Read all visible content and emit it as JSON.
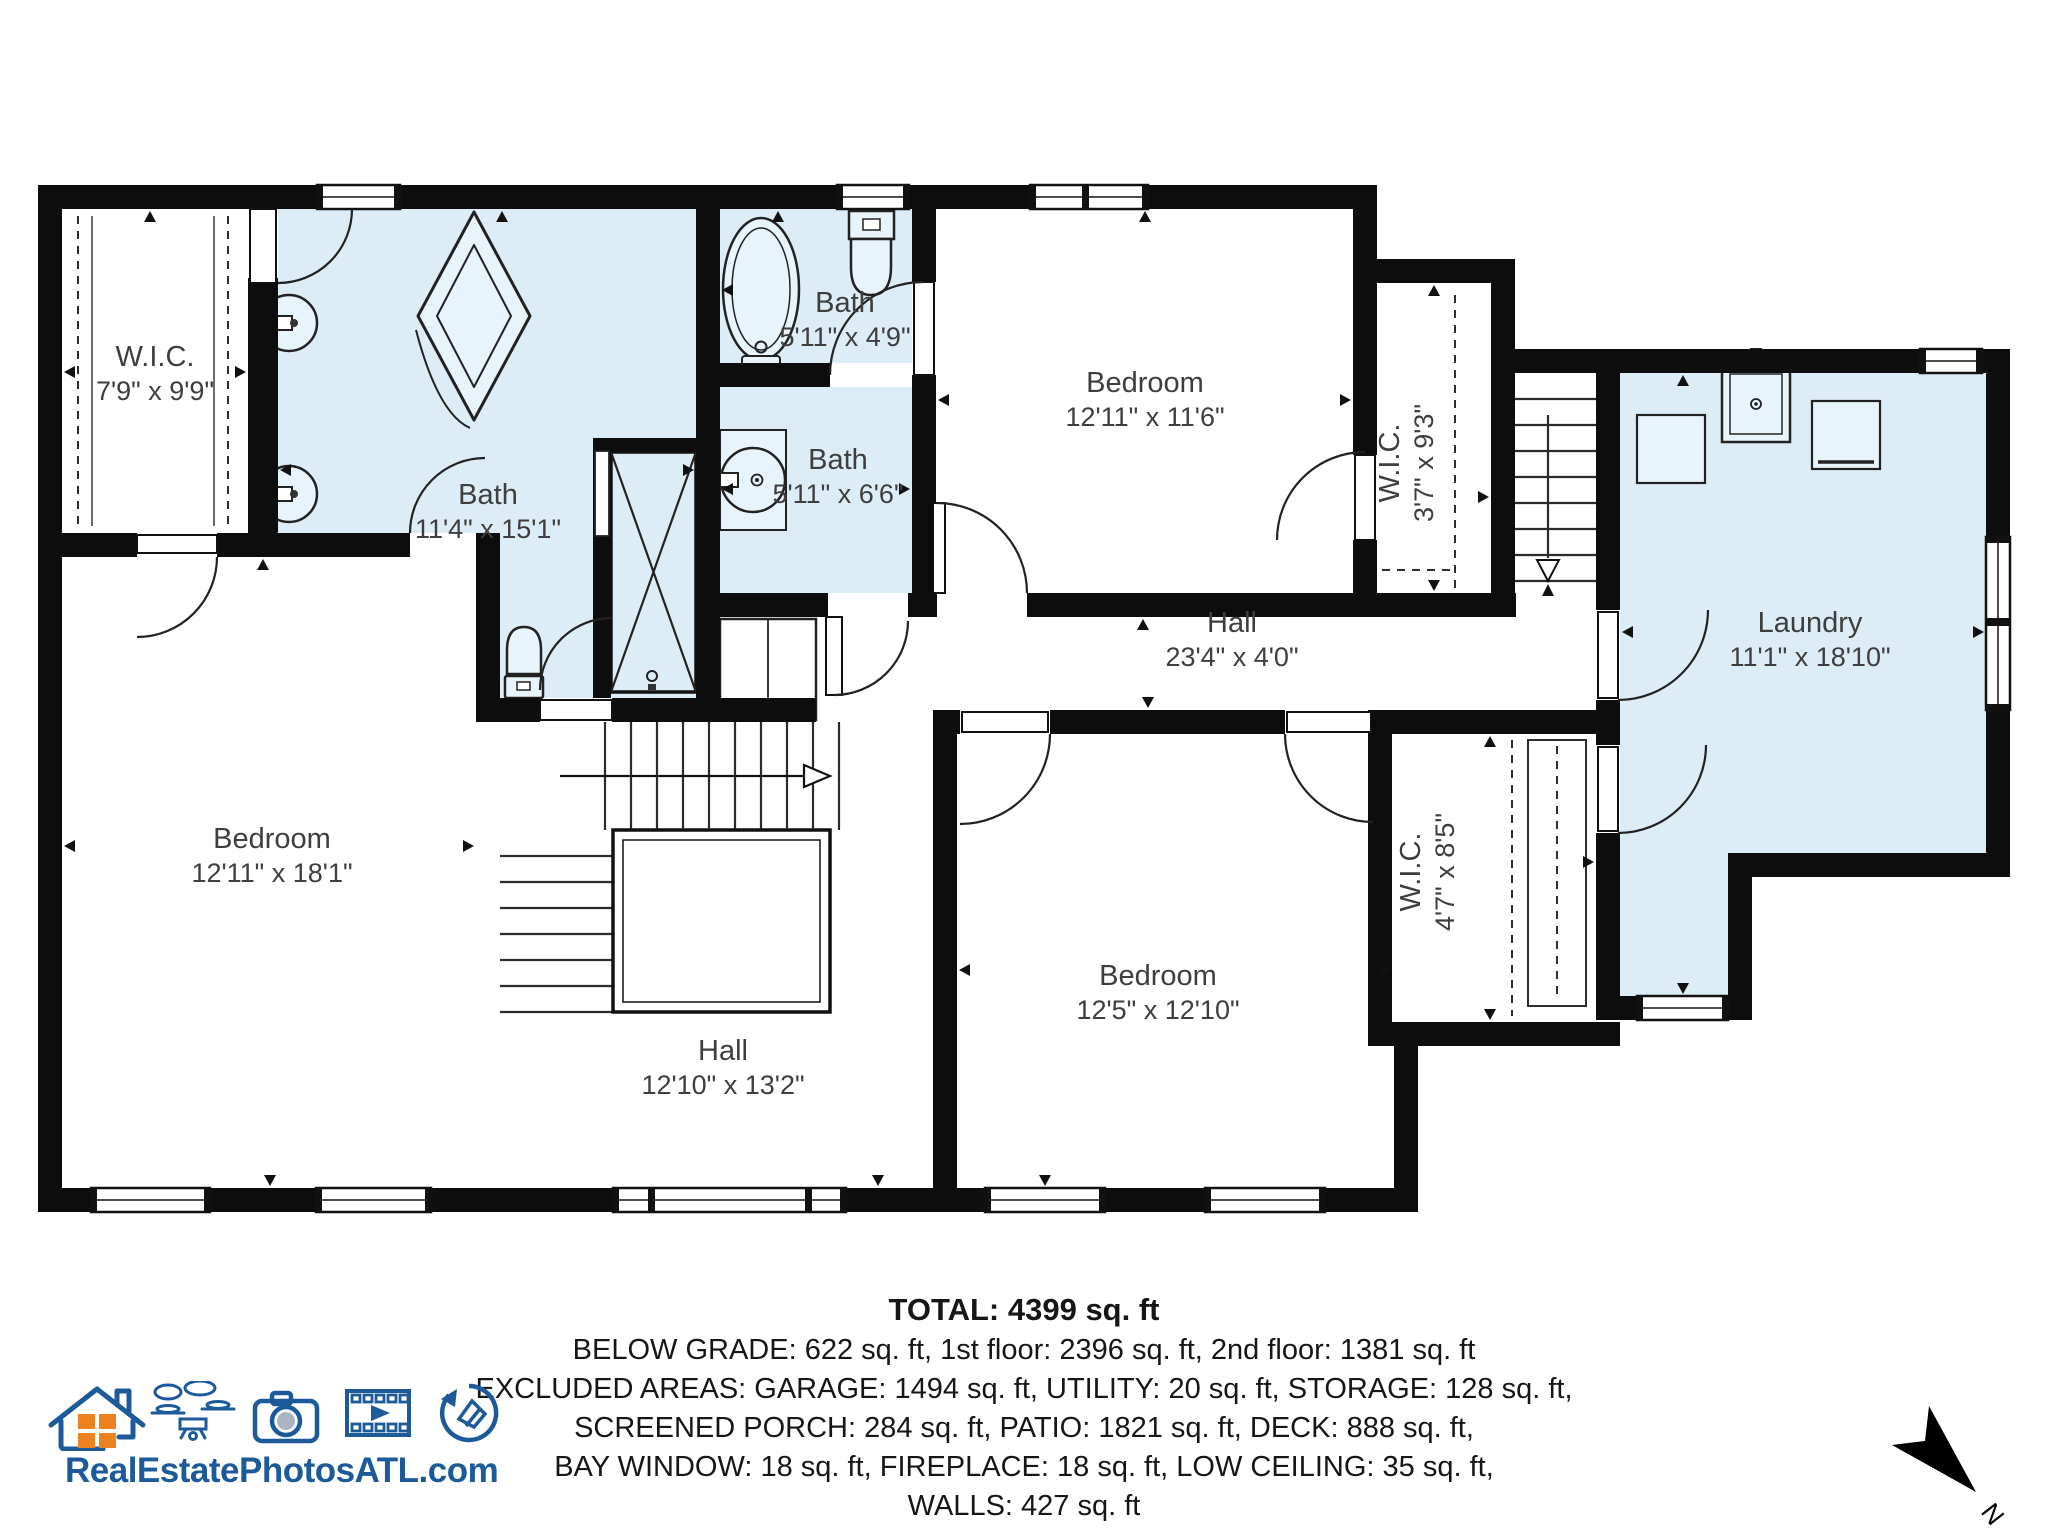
{
  "rooms": {
    "wic1": {
      "name": "W.I.C.",
      "dims": "7'9\" x 9'9\""
    },
    "bath_master": {
      "name": "Bath",
      "dims": "11'4\" x 15'1\""
    },
    "bath_small_top": {
      "name": "Bath",
      "dims": "5'11\" x 4'9\""
    },
    "bath_small_mid": {
      "name": "Bath",
      "dims": "5'11\" x 6'6\""
    },
    "bedroom_top": {
      "name": "Bedroom",
      "dims": "12'11\" x 11'6\""
    },
    "wic2": {
      "name": "W.I.C.",
      "dims": "3'7\" x 9'3\""
    },
    "laundry": {
      "name": "Laundry",
      "dims": "11'1\" x 18'10\""
    },
    "hall_upper": {
      "name": "Hall",
      "dims": "23'4\" x 4'0\""
    },
    "bedroom_master": {
      "name": "Bedroom",
      "dims": "12'11\" x 18'1\""
    },
    "hall_lower": {
      "name": "Hall",
      "dims": "12'10\" x 13'2\""
    },
    "bedroom_third": {
      "name": "Bedroom",
      "dims": "12'5\" x 12'10\""
    },
    "wic3": {
      "name": "W.I.C.",
      "dims": "4'7\" x 8'5\""
    }
  },
  "footer": {
    "total": "TOTAL: 4399 sq. ft",
    "line1": "BELOW GRADE: 622 sq. ft, 1st floor: 2396 sq. ft, 2nd floor: 1381 sq. ft",
    "line2": "EXCLUDED AREAS: GARAGE: 1494 sq. ft, UTILITY: 20 sq. ft, STORAGE: 128 sq. ft,",
    "line3": "SCREENED PORCH: 284 sq. ft, PATIO: 1821 sq. ft, DECK: 888 sq. ft,",
    "line4": "BAY WINDOW: 18 sq. ft, FIREPLACE: 18 sq. ft, LOW CEILING: 35 sq. ft,",
    "line5": "WALLS: 427 sq. ft",
    "disclaimer": "Measurements Deemed Highly Reliable, But Not Guaranteed."
  },
  "branding": {
    "website": "RealEstatePhotosATL.com"
  },
  "compass": {
    "north_label": "N"
  },
  "colors": {
    "room_fill": "#dcedf8",
    "wall": "#0d0d0d",
    "logo_blue": "#1c5a99",
    "logo_orange": "#ef8220"
  }
}
